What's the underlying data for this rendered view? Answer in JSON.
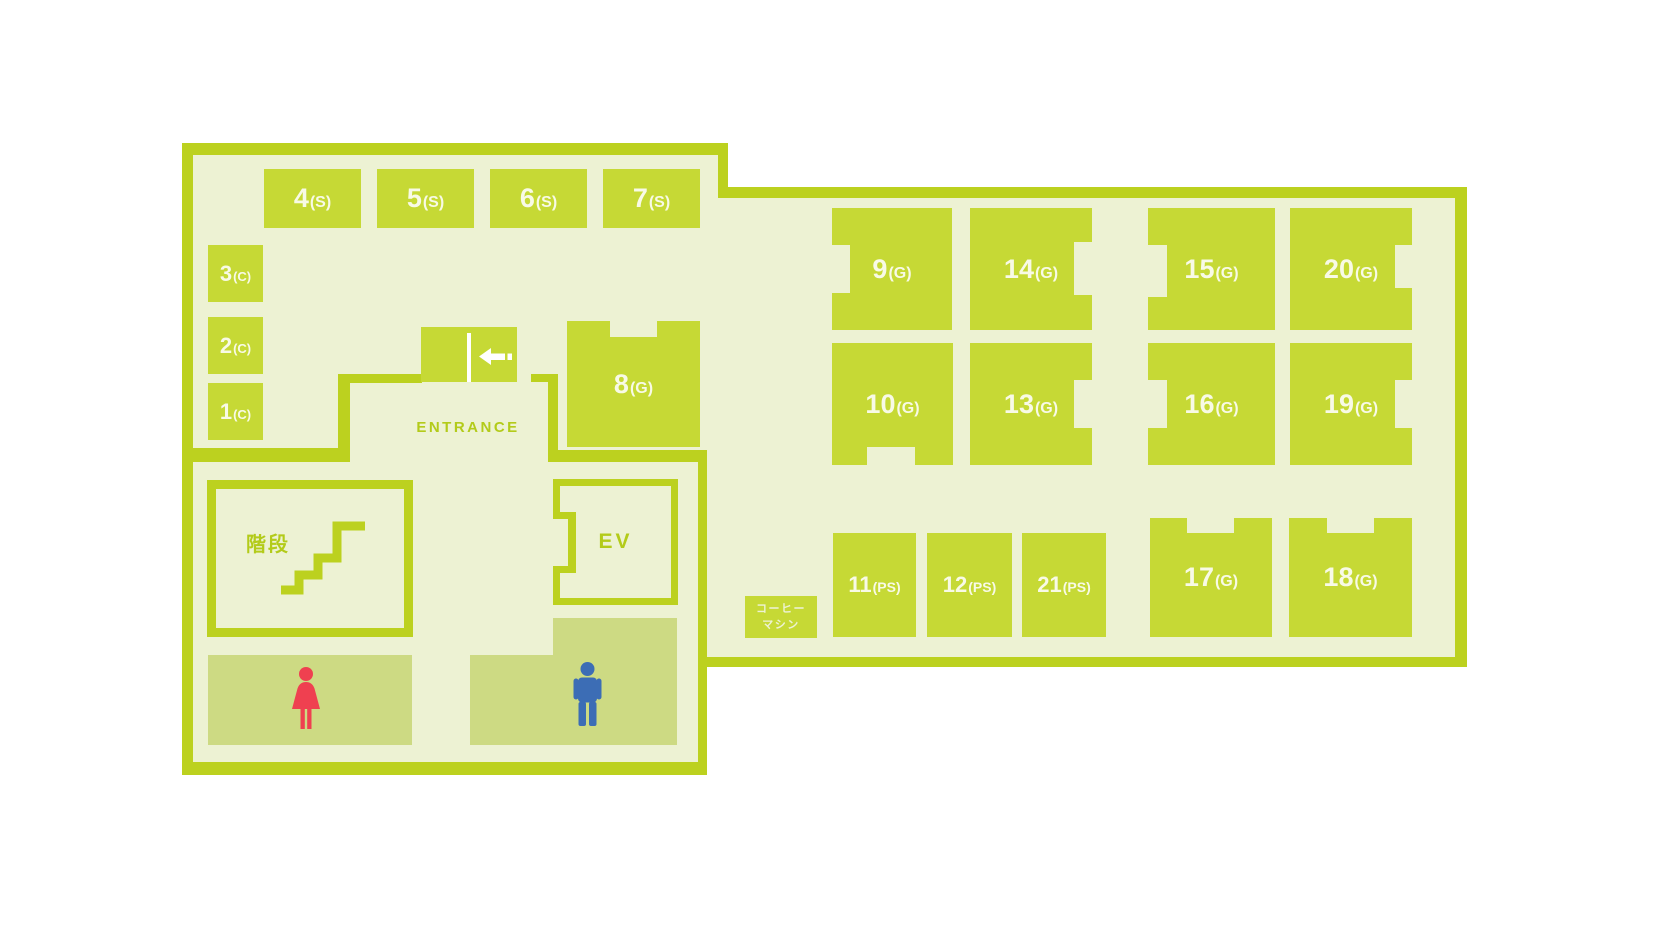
{
  "labels": {
    "entrance": "ENTRANCE",
    "stairs": "階段",
    "elevator": "EV",
    "coffee_line1": "コーヒー",
    "coffee_line2": "マシン"
  },
  "rooms": {
    "r1": {
      "number": "1",
      "suffix": "(C)"
    },
    "r2": {
      "number": "2",
      "suffix": "(C)"
    },
    "r3": {
      "number": "3",
      "suffix": "(C)"
    },
    "r4": {
      "number": "4",
      "suffix": "(S)"
    },
    "r5": {
      "number": "5",
      "suffix": "(S)"
    },
    "r6": {
      "number": "6",
      "suffix": "(S)"
    },
    "r7": {
      "number": "7",
      "suffix": "(S)"
    },
    "r8": {
      "number": "8",
      "suffix": "(G)"
    },
    "r9": {
      "number": "9",
      "suffix": "(G)"
    },
    "r10": {
      "number": "10",
      "suffix": "(G)"
    },
    "r11": {
      "number": "11",
      "suffix": "(PS)"
    },
    "r12": {
      "number": "12",
      "suffix": "(PS)"
    },
    "r13": {
      "number": "13",
      "suffix": "(G)"
    },
    "r14": {
      "number": "14",
      "suffix": "(G)"
    },
    "r15": {
      "number": "15",
      "suffix": "(G)"
    },
    "r16": {
      "number": "16",
      "suffix": "(G)"
    },
    "r17": {
      "number": "17",
      "suffix": "(G)"
    },
    "r18": {
      "number": "18",
      "suffix": "(G)"
    },
    "r19": {
      "number": "19",
      "suffix": "(G)"
    },
    "r20": {
      "number": "20",
      "suffix": "(G)"
    },
    "r21": {
      "number": "21",
      "suffix": "(PS)"
    }
  },
  "colors": {
    "wall_green": "#bcd11f",
    "room_green": "#c6d935",
    "floor_pale": "#edf2d3",
    "restroom_olive": "#cdda83",
    "female_red": "#ef4050",
    "male_blue": "#3c6db5",
    "room_text": "#f8fae6",
    "green_text": "#b3cb1a"
  }
}
